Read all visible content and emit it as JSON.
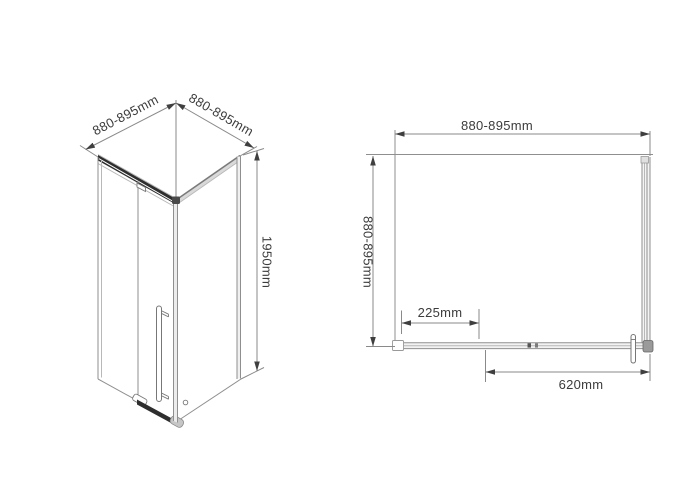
{
  "drawing": {
    "type": "shower-enclosure-dimensional-drawing",
    "colors": {
      "background": "#ffffff",
      "line": "#8f8f8f",
      "dark_rail": "#2e2e2e",
      "text": "#3c3c3c",
      "arrow": "#3f3f3f",
      "light_fill": "#ececec"
    },
    "isometric_view": {
      "dim_width_left": "880-895mm",
      "dim_width_right": "880-895mm",
      "dim_height": "1950mm"
    },
    "plan_view": {
      "dim_width_top": "880-895mm",
      "dim_depth_left": "880-895mm",
      "dim_fixed_panel": "225mm",
      "dim_door": "620mm"
    }
  }
}
